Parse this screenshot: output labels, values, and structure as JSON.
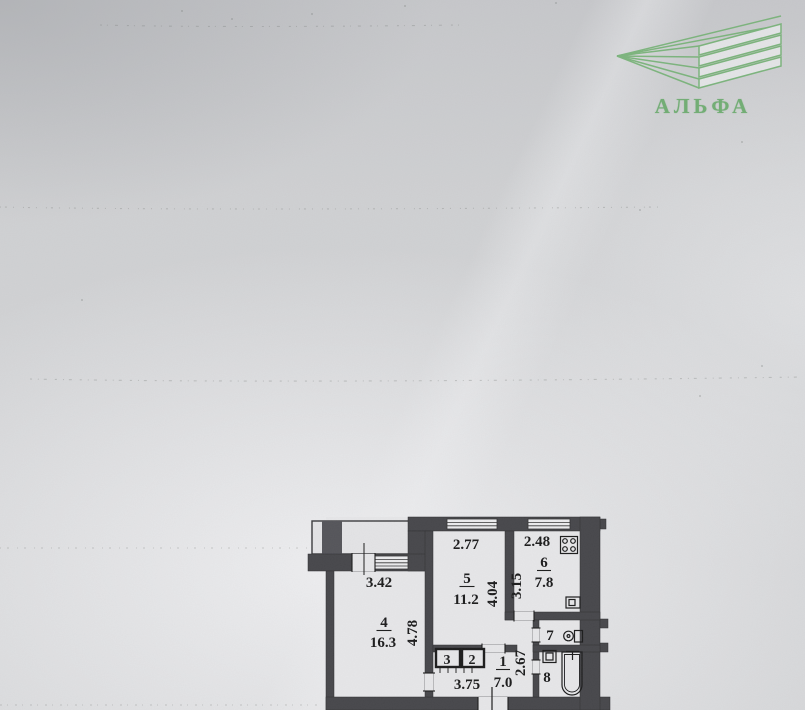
{
  "logo": {
    "brand": "АЛЬФА",
    "accent_color": "#72ae74",
    "mark": "stacked-layers-chevron-icon"
  },
  "floor_plan": {
    "paper_color": "#d2d3d5",
    "wall_color": "#47474b",
    "line_color": "#1b1b1d",
    "rooms": {
      "r4": {
        "number": "4",
        "area": "16.3",
        "width_dim": "3.42",
        "height_dim": "4.78"
      },
      "r5": {
        "number": "5",
        "area": "11.2",
        "width_dim": "2.77",
        "height_dim": "4.04"
      },
      "r6": {
        "number": "6",
        "area": "7.8",
        "width_dim": "2.48",
        "height_dim": "3.15"
      },
      "r7": {
        "number": "7"
      },
      "r8": {
        "number": "8"
      },
      "r1": {
        "number": "1",
        "area": "7.0",
        "width_dim": "3.75",
        "height_dim": "2.67"
      },
      "c3": {
        "number": "3"
      },
      "c2": {
        "number": "2"
      }
    },
    "icons": {
      "stove": "stove-icon",
      "kitchen_sink": "kitchen-sink-icon",
      "toilet": "toilet-icon",
      "washbasin": "washbasin-icon",
      "bathtub": "bathtub-icon"
    }
  }
}
